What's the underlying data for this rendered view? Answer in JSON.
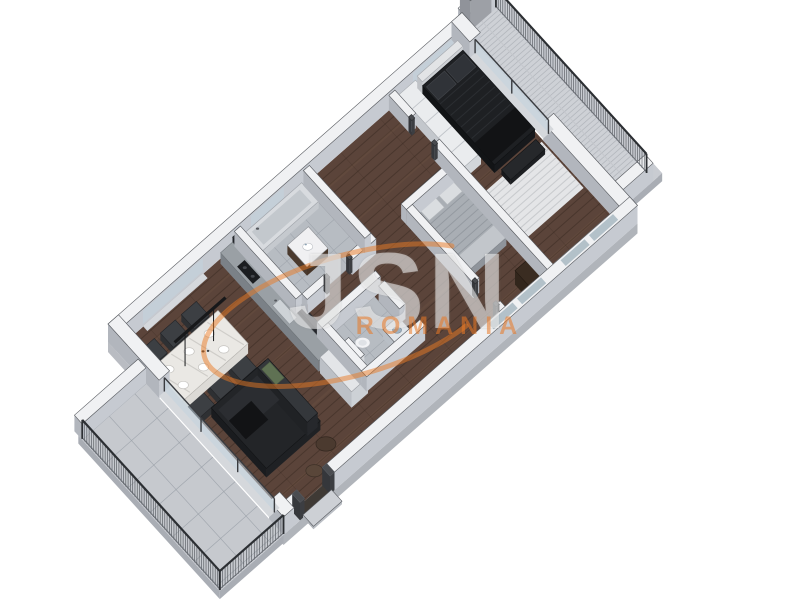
{
  "watermark": {
    "logo": "JSN",
    "country": "ROMANIA",
    "accent_color": "#e97924"
  },
  "scene": {
    "type": "3d-floorplan-render",
    "regions": [
      "living-dining-kitchen",
      "bathroom",
      "wc",
      "hallway",
      "bedroom",
      "master-bedroom",
      "balcony-southwest",
      "balcony-northeast"
    ],
    "furniture": [
      "dining-table",
      "dining-chairs",
      "pendant-lamp",
      "sofa",
      "poufs",
      "kitchen-counter",
      "bathtub",
      "vanity-sink",
      "toilet",
      "washing-machine",
      "double-bed-gray",
      "double-bed-dark",
      "rug",
      "wardrobe",
      "shelving-unit"
    ]
  },
  "palette": {
    "bg": "#ffffff",
    "wall_top": "#f0f1f3",
    "wall_side": "#c6cad1",
    "wall_side2": "#b2b6bd",
    "outline": "#55585d",
    "floor_wood": "#5b443a",
    "wood_line": "#32241c",
    "wood_hi": "#8a6a52",
    "tile": "#b7bcc2",
    "tile_line": "#9aa0a8",
    "deck": "#ced1d6",
    "deck_line": "#b1b5bb",
    "slab": "#c9ccd2",
    "slab_dark": "#a9adb4",
    "sofa": "#232528",
    "sofa_hi": "#34373b",
    "pillow_green": "#5f7153",
    "pouf": "#4b3a2f",
    "pouf2": "#594639",
    "table_top": "#eae8e4",
    "marble_line": "#c9c7c3",
    "chair": "#2e3033",
    "chair_hi": "#3c3f43",
    "bed_dark": "#1e2023",
    "bed_dark_hi": "#2f3236",
    "throw_dark": "#121315",
    "bed_gray": "#a9aeb4",
    "bed_gray_line": "#8f959c",
    "pillow_light": "#dadde0",
    "blanket": "#c2c6cb",
    "rug": "#e4e5e7",
    "rug_line": "#c7c9cc",
    "wood_furn": "#463528",
    "wood_furn_top": "#3a2c21",
    "white_furn": "#eaecee",
    "headboard": "#e2e4e6",
    "counter": "#9aa0a5",
    "backsplash": "#23252a",
    "sink": "#ced3d7",
    "cooktop": "#1b1d20",
    "glass": "rgba(195,212,222,0.55)",
    "glass_top": "#9fb0bb",
    "sill": "#d5d8dc",
    "railing_dark": "#2c2f33",
    "railing_mid": "#4b4f55",
    "railing_lt": "#6a6e74",
    "entry_floor": "#3f3a35",
    "step": "#cdd0d5"
  }
}
